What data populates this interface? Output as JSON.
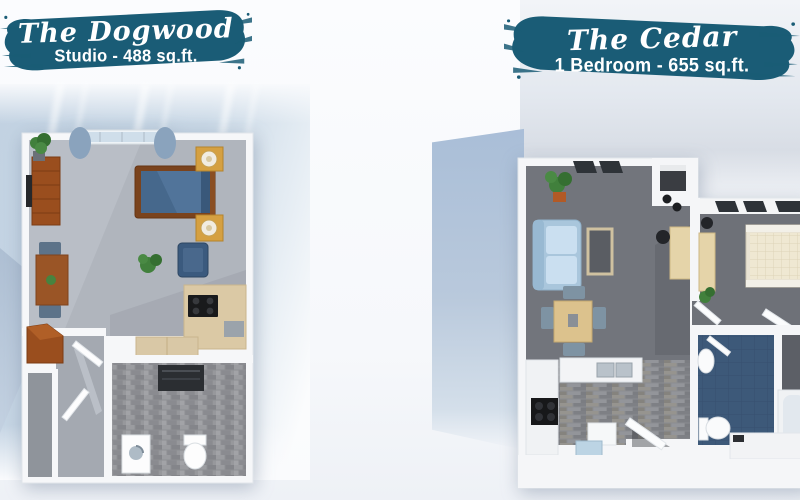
{
  "brand": {
    "banner_color": "#1a5c76",
    "banner_text_color": "#ffffff"
  },
  "plans": [
    {
      "id": "dogwood",
      "title": "The Dogwood",
      "subtitle": "Studio - 488 sq.ft."
    },
    {
      "id": "cedar",
      "title": "The Cedar",
      "subtitle": "1 Bedroom - 655 sq.ft."
    }
  ]
}
